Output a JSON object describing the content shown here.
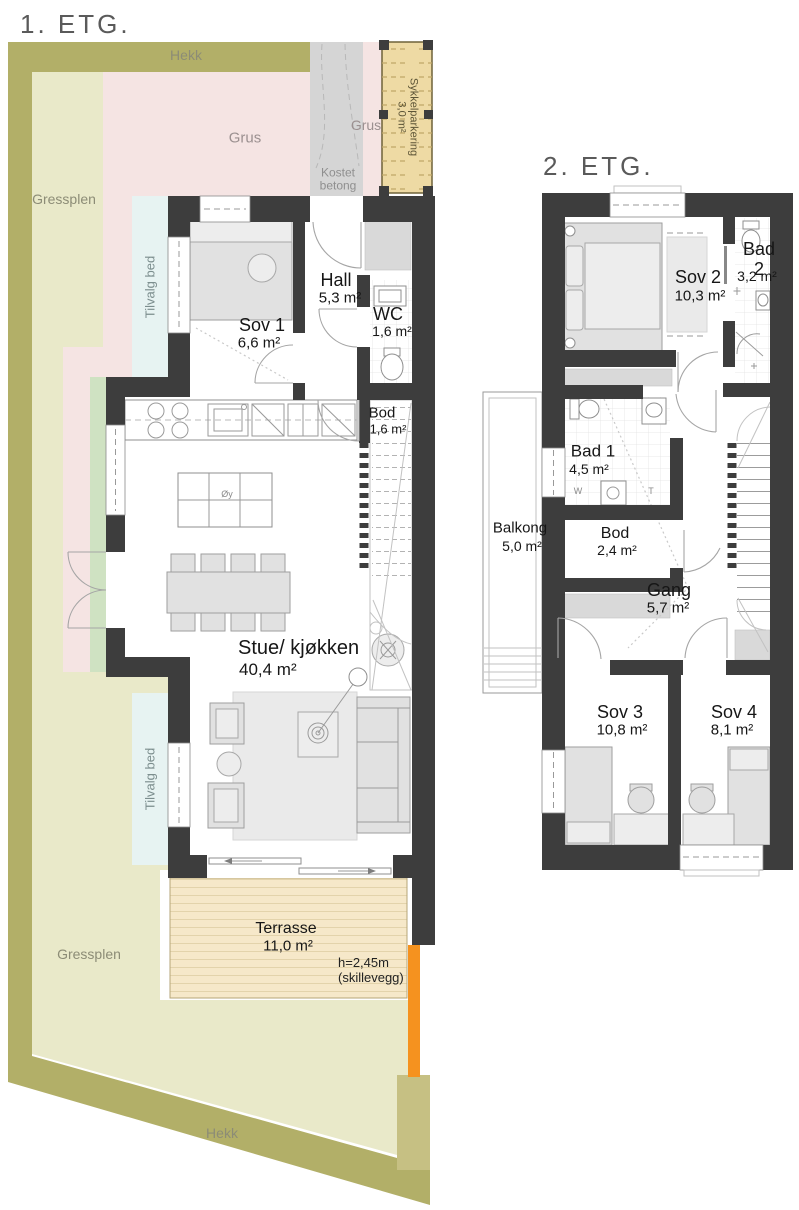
{
  "floor1": {
    "title": "1. ETG.",
    "site_labels": {
      "hekk_top": "Hekk",
      "hekk_bottom": "Hekk",
      "gressplen_top": "Gressplen",
      "gressplen_bottom": "Gressplen",
      "grus_a": "Grus",
      "grus_b": "Grus",
      "kostet_betong": "Kostet\nbetong",
      "tilvalg_bed_a": "Tilvalg bed",
      "tilvalg_bed_b": "Tilvalg bed",
      "sykkelparkering": "Sykkelparkering\n3,0 m²"
    },
    "rooms": {
      "sov1": {
        "name": "Sov 1",
        "area": "6,6 m²"
      },
      "hall": {
        "name": "Hall",
        "area": "5,3 m²"
      },
      "wc": {
        "name": "WC",
        "area": "1,6 m²"
      },
      "bod": {
        "name": "Bod",
        "area": "1,6 m²"
      },
      "stue": {
        "name": "Stue/ kjøkken",
        "area": "40,4 m²"
      },
      "terrasse": {
        "name": "Terrasse",
        "area": "11,0 m²"
      }
    },
    "annotations": {
      "kitchen_island": "Øy",
      "skillevegg": "h=2,45m\n(skillevegg)"
    }
  },
  "floor2": {
    "title": "2. ETG.",
    "rooms": {
      "sov2": {
        "name": "Sov 2",
        "area": "10,3 m²"
      },
      "bad2": {
        "name": "Bad 2",
        "area": "3,2 m²"
      },
      "bad1": {
        "name": "Bad 1",
        "area": "4,5 m²"
      },
      "balkong": {
        "name": "Balkong",
        "area": "5,0 m²"
      },
      "bod": {
        "name": "Bod",
        "area": "2,4 m²"
      },
      "gang": {
        "name": "Gang",
        "area": "5,7 m²"
      },
      "sov3": {
        "name": "Sov 3",
        "area": "10,8 m²"
      },
      "sov4": {
        "name": "Sov 4",
        "area": "8,1 m²"
      }
    },
    "annotations": {
      "washer": "W",
      "dryer": "T"
    }
  },
  "colors": {
    "wall": "#3d3d3d",
    "hedge": "#b2af68",
    "lawn": "#e9e9c9",
    "gravel_pink": "#f5e4e3",
    "concrete": "#d5d5d5",
    "bike_shed": "#eedaa4",
    "terrace": "#f6e8c9",
    "partition_orange": "#f5921f",
    "optional_bed_cyan": "#e7f3f2",
    "planting_green": "#cfe2c2",
    "corner_block": "#c6c083"
  }
}
